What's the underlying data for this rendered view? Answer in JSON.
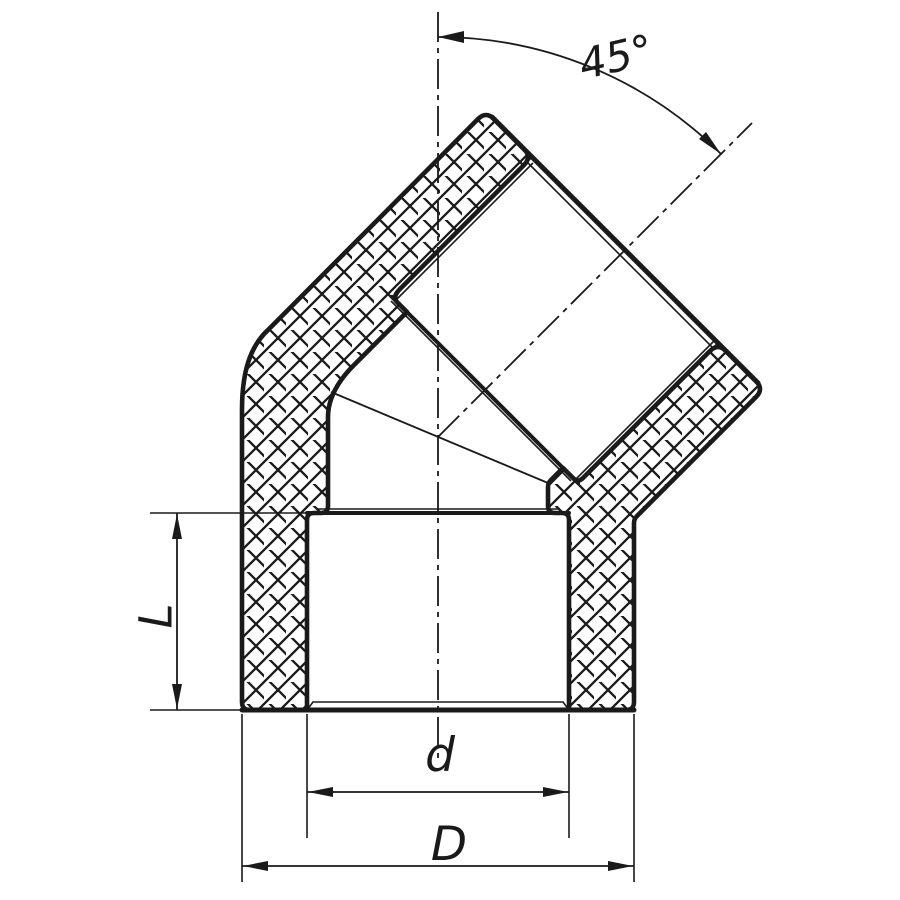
{
  "dimensions": {
    "angle_label": "45°",
    "length_label": "L",
    "inner_diameter_label": "d",
    "outer_diameter_label": "D"
  },
  "colors": {
    "line": "#1a1a1a",
    "background": "#ffffff"
  }
}
